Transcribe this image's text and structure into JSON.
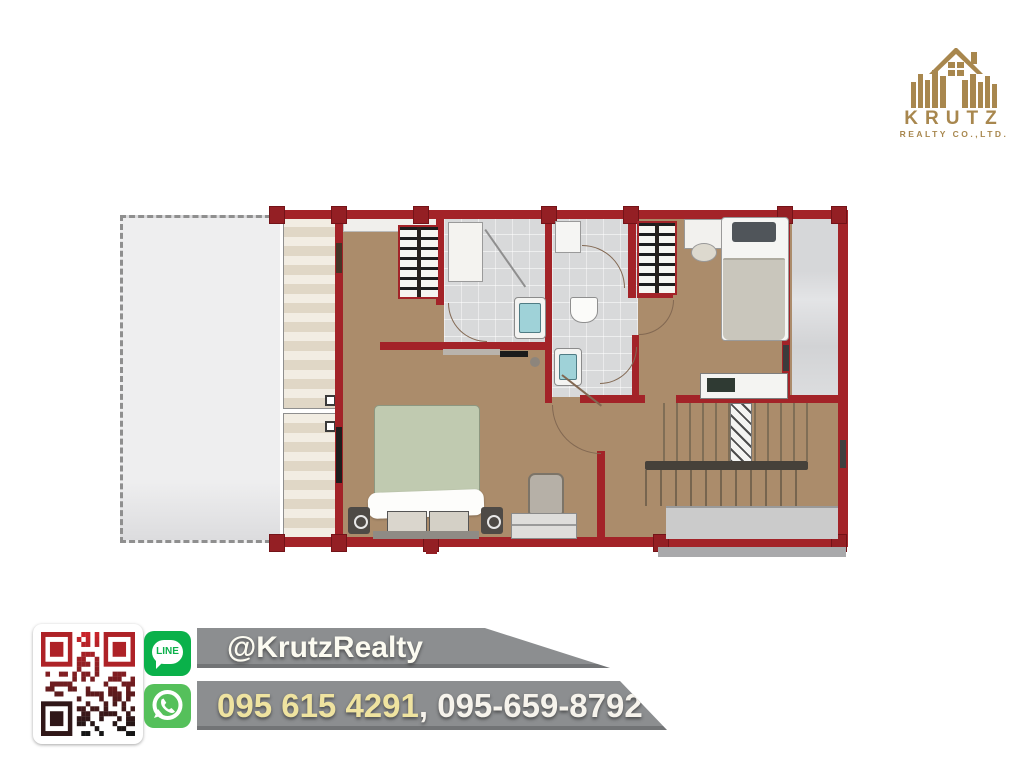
{
  "brand": {
    "logo_title": "KRUTZ",
    "logo_subtitle": "REALTY CO.,LTD.",
    "logo_color": "#a8874e"
  },
  "contact": {
    "line_label": "LINE",
    "line_handle": "@KrutzRealty",
    "phone_primary": "095 615 4291",
    "phone_secondary": ", 095-659-8792",
    "banner_color": "#8c8e90",
    "line_green": "#0ab14a",
    "whatsapp_green": "#55c05b",
    "qr_top_color": "#c9242a",
    "qr_bottom_color": "#151515"
  },
  "floor_plan": {
    "wall_color": "#a32328",
    "wood_floor_color": "#ab8c6b",
    "bath_floor_color": "#d8d9da",
    "terrace_color": "#eeeeef",
    "roof_tile_color": "#e9e1d2",
    "balcony_color": "#d4d5d7",
    "master_bed_blanket": "#c0cab0",
    "single_bed_blanket": "#c9c6bc"
  }
}
